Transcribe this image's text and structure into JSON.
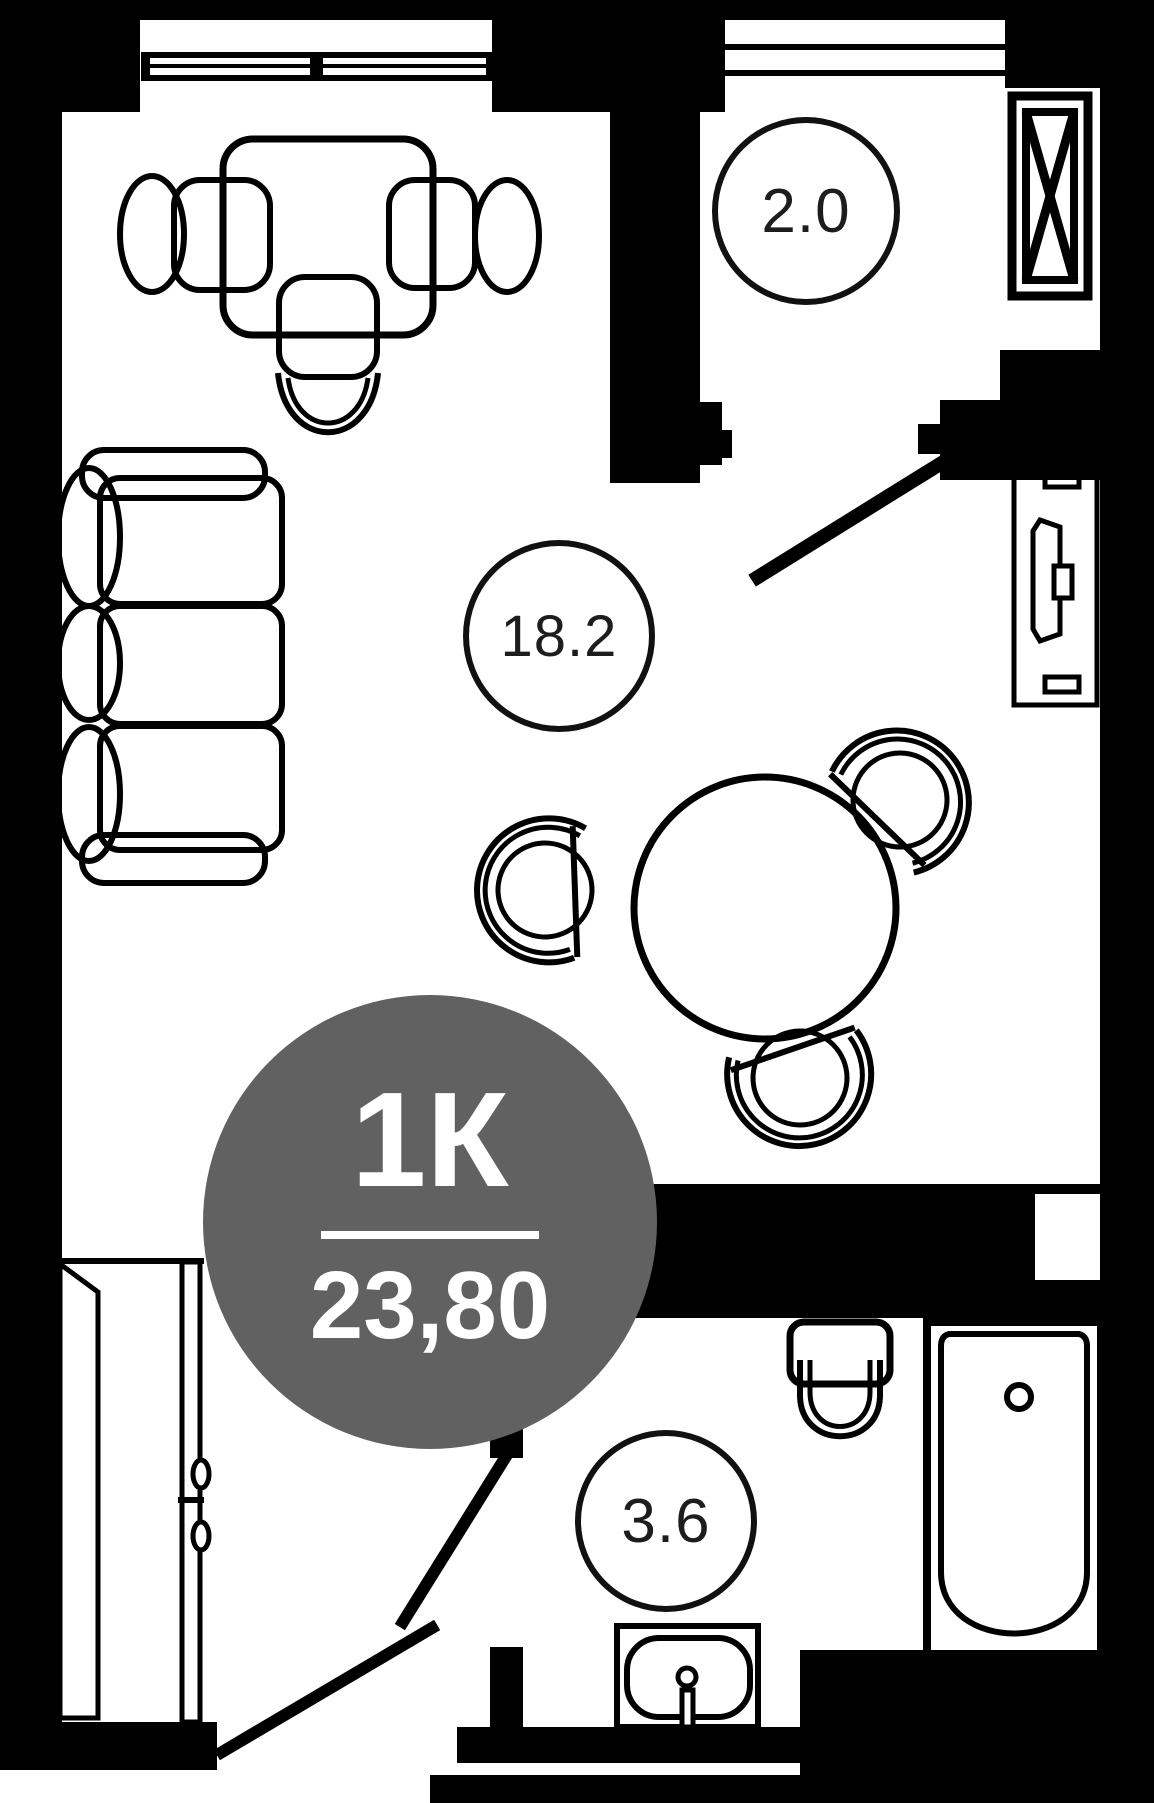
{
  "plan": {
    "badge": {
      "type": "1К",
      "area": "23,80"
    },
    "rooms": [
      {
        "id": "living-room",
        "area_label": "18.2"
      },
      {
        "id": "balcony",
        "area_label": "2.0"
      },
      {
        "id": "bathroom",
        "area_label": "3.6"
      }
    ],
    "furniture": [
      "desk-with-chairs",
      "sofa",
      "dining-table-with-chairs",
      "tv-console",
      "wardrobe",
      "toilet",
      "bathtub",
      "sink",
      "ventilation-shaft",
      "window",
      "balcony-window",
      "door-swings"
    ],
    "colors": {
      "walls": "#000000",
      "background": "#ffffff",
      "badge_bg": "#616161",
      "badge_text": "#ffffff",
      "label_text": "#1d1d1d"
    }
  }
}
